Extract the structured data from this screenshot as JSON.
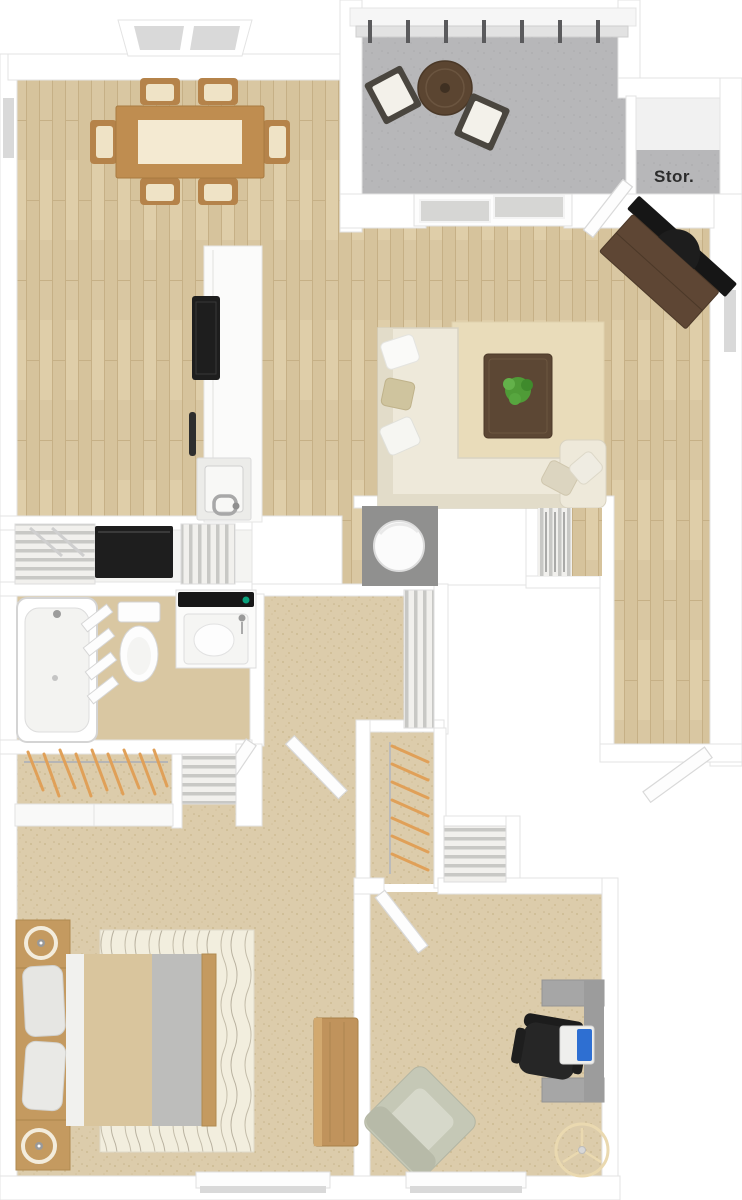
{
  "floorplan": {
    "labels": {
      "storage": "Stor."
    },
    "colors": {
      "background": "#ffffff",
      "wall": "#ffffff",
      "wall_edge": "#e3e3e3",
      "wood_floor": "#d9c7a2",
      "wood_plank_line": "#c6b086",
      "carpet": "#dcccab",
      "bathroom_floor": "#d9c7a2",
      "patio_concrete": "#b7b7b9",
      "glass": "#d9d9d9",
      "sofa": "#eee9da",
      "rug": "#e9dcba",
      "bed_rug": "#f2eede",
      "dark_wood": "#5c4734",
      "tv_console": "#5e4634",
      "wood_furniture": "#bf8d50",
      "bed_frame": "#c49a60",
      "bed_blanket": "#d9c59d",
      "appliance_black": "#1e1e1e",
      "desk_gray": "#a6a6a6",
      "laptop_screen": "#2e6fd2",
      "armchair": "#c5c8b6",
      "hanger_orange": "#e0a058",
      "plant_green": "#4f9b37",
      "fan_symbol": "#ead9b0",
      "label_text": "#2c2c2c"
    }
  }
}
